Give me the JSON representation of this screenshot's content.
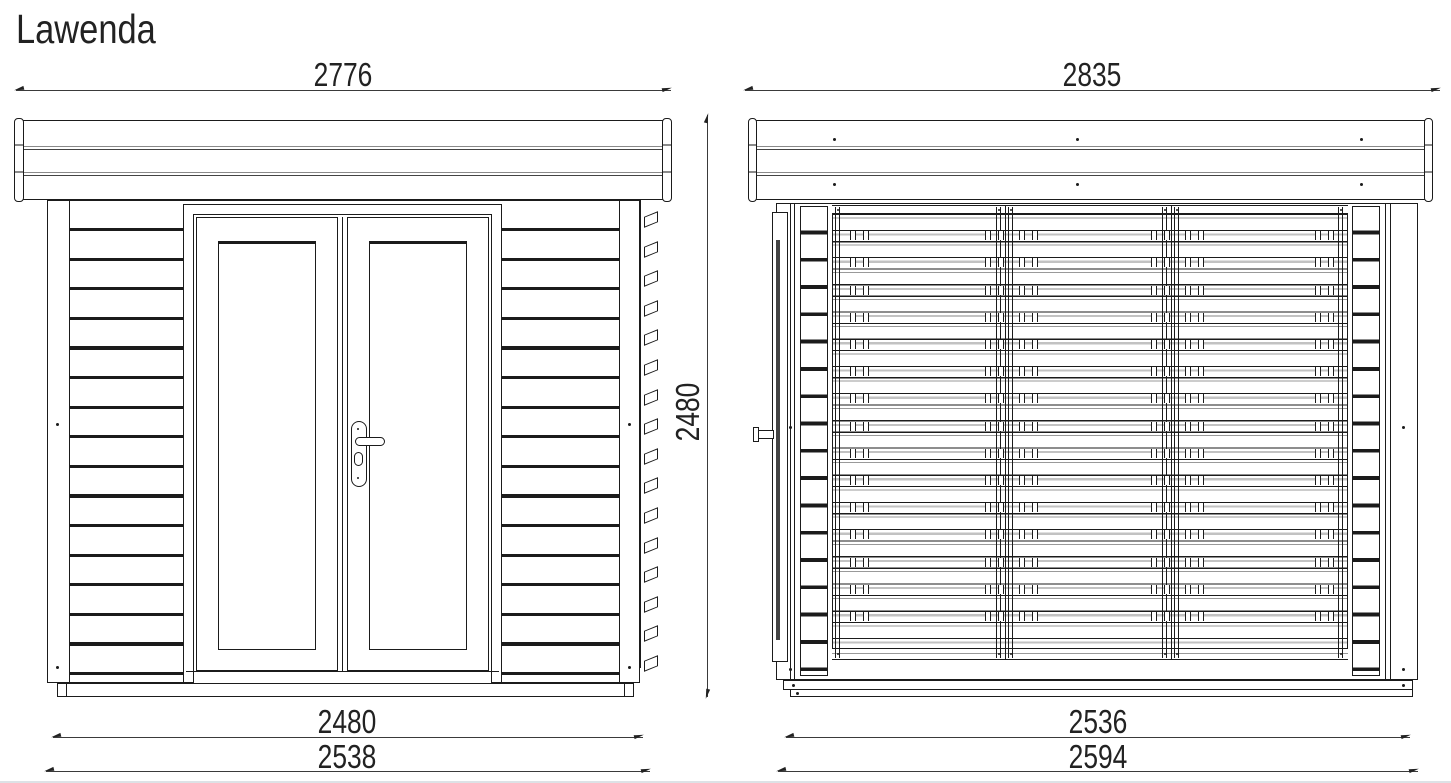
{
  "title": "Lawenda",
  "colors": {
    "ink": "#1b1b1b",
    "dim_line": "#3a3a3a",
    "separator_gray": "#8a8a8a",
    "louver_shadow": "#c2c2c2",
    "page_edge": "#dde2e6",
    "background": "#ffffff"
  },
  "front_view": {
    "dim_overall_width": "2776",
    "dim_height": "2480",
    "dim_wall_width": "2480",
    "dim_base_width": "2538"
  },
  "side_view": {
    "dim_overall_width": "2835",
    "dim_wall_width": "2536",
    "dim_base_width": "2594"
  }
}
